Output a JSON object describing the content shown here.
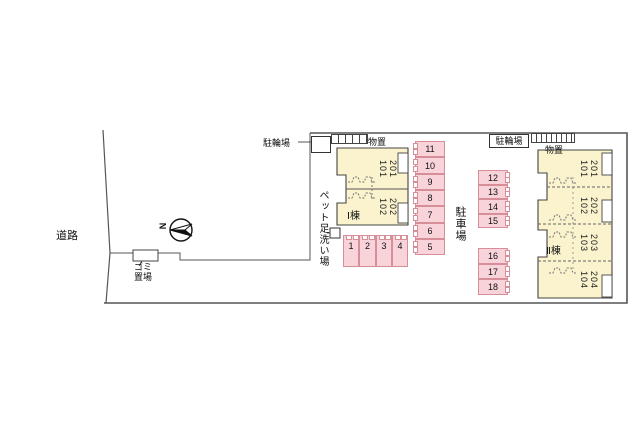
{
  "road": {
    "label": "道路"
  },
  "compass": {
    "label": "N"
  },
  "garbage": {
    "line1": "ゴミ",
    "line2": "置場"
  },
  "pet_wash": {
    "label": "ペット足洗い場"
  },
  "bicycle_left": {
    "label": "駐輪場"
  },
  "storage_left": {
    "label": "物置"
  },
  "bicycle_right": {
    "label": "駐輪場"
  },
  "storage_right": {
    "label": "物置"
  },
  "parking_area": {
    "label": "駐車場"
  },
  "building1": {
    "name": "Ⅰ棟",
    "units": [
      {
        "upper": "201",
        "lower": "101"
      },
      {
        "upper": "202",
        "lower": "102"
      }
    ]
  },
  "building2": {
    "name": "Ⅱ棟",
    "units": [
      {
        "upper": "201",
        "lower": "101"
      },
      {
        "upper": "202",
        "lower": "102"
      },
      {
        "upper": "203",
        "lower": "103"
      },
      {
        "upper": "204",
        "lower": "104"
      }
    ]
  },
  "parking_stalls": {
    "south_row": [
      "1",
      "2",
      "3",
      "4"
    ],
    "west_column": [
      "11",
      "10",
      "9",
      "8",
      "7",
      "6",
      "5"
    ],
    "east_column_upper": [
      "12",
      "13",
      "14",
      "15"
    ],
    "east_column_lower": [
      "16",
      "17",
      "18"
    ]
  },
  "colors": {
    "building_fill": "#faf3cd",
    "building_border": "#444444",
    "stall_fill": "#f8d3da",
    "stall_border": "#d68f98",
    "boundary_line": "#555555",
    "background": "#ffffff"
  }
}
